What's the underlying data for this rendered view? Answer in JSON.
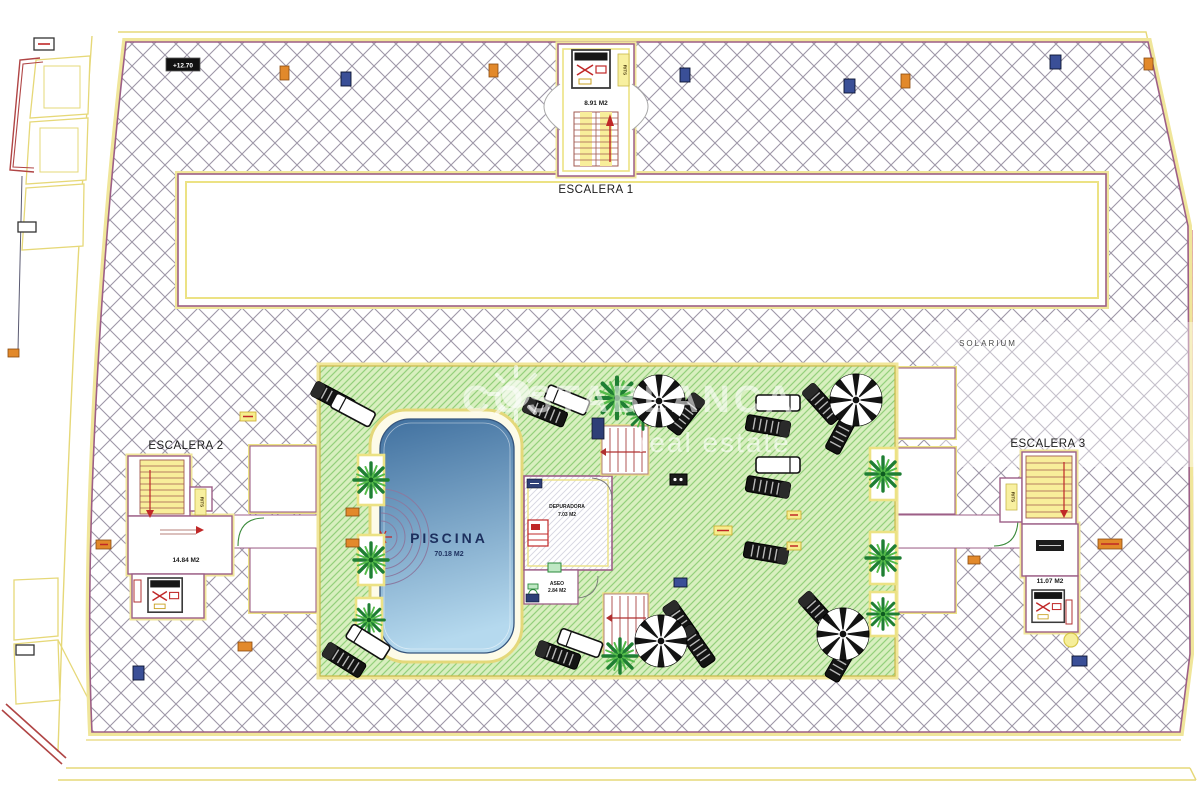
{
  "drawing": {
    "type": "architectural roof / solarium floor plan",
    "watermark": {
      "brand": "COSTABLANCA",
      "tagline": "real estate",
      "logo": "sun-icon"
    },
    "solarium_label": "SOLARIUM",
    "level_mark": "+12.70",
    "escalera1": {
      "name": "ESCALERA 1",
      "area": "8.91 M2",
      "duct": "RITS"
    },
    "escalera2": {
      "name": "ESCALERA 2",
      "area": "14.84 M2",
      "duct": "RITS"
    },
    "escalera3": {
      "name": "ESCALERA 3",
      "area": "11.07 M2",
      "duct": "RITS"
    },
    "piscina": {
      "name": "PISCINA",
      "area": "70.18 M2"
    },
    "depuradora": {
      "name": "DEPURADORA",
      "area": "7.03 M2"
    },
    "aseo": {
      "name": "ASEO",
      "area": "2.84 M2"
    },
    "icons": {
      "palm": "palm-tree-icon",
      "umbrella": "parasol-icon",
      "lounger": "sun-lounger-icon",
      "lift": "elevator-icon",
      "stair": "staircase-icon",
      "sun": "sun-icon"
    },
    "colors": {
      "roof_hatch_line": "#9e97a8",
      "terrace_green": "#d8efbf",
      "terrace_hatch": "#94d07c",
      "pool_top": "#40709f",
      "pool_bottom": "#b5d9ee",
      "boundary_yellow": "#ece284",
      "boundary_purple": "#9d5f87",
      "marker_orange": "#e2892b",
      "marker_blue": "#3a4f97",
      "marker_yellow": "#f6ee8e",
      "accent_red": "#c02828"
    }
  }
}
